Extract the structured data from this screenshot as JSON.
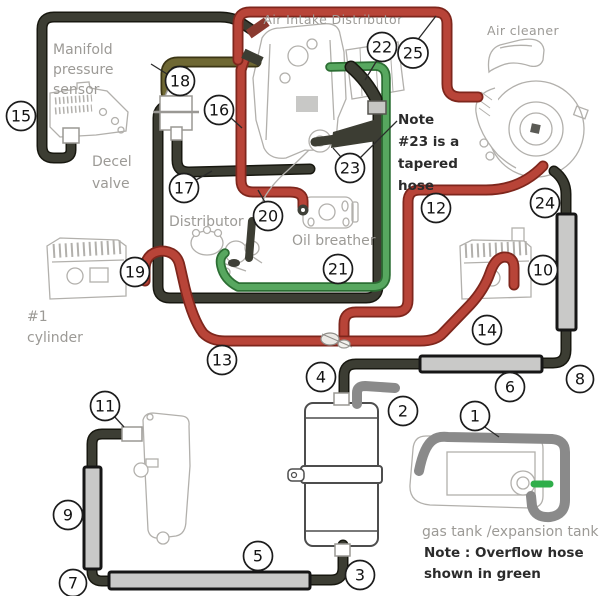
{
  "diagram": {
    "labels": {
      "air_intake_distributor": "Air Intake Distributor",
      "air_cleaner": "Air cleaner",
      "manifold_sensor": [
        "Manifold",
        "pressure",
        "sensor"
      ],
      "decel_valve": [
        "Decel",
        "valve"
      ],
      "distributor": "Distributor",
      "oil_breather": "Oil breather",
      "cylinder1": [
        "#1",
        "cylinder"
      ],
      "gas_tank": "gas tank /expansion tank",
      "note23": [
        "Note",
        "#23 is a",
        "tapered",
        "hose"
      ],
      "note_overflow": [
        "Note : Overflow hose",
        "shown in green"
      ]
    },
    "callouts": {
      "c1": "1",
      "c2": "2",
      "c3": "3",
      "c4": "4",
      "c5": "5",
      "c6": "6",
      "c7": "7",
      "c8": "8",
      "c9": "9",
      "c10": "10",
      "c11": "11",
      "c12": "12",
      "c13": "13",
      "c14": "14",
      "c15": "15",
      "c16": "16",
      "c17": "17",
      "c18": "18",
      "c19": "19",
      "c20": "20",
      "c21": "21",
      "c22": "22",
      "c23": "23",
      "c24": "24",
      "c25": "25"
    },
    "colors": {
      "hose_red": "#b84438",
      "hose_red_outline": "#7e261c",
      "hose_dark": "#3c3d33",
      "hose_dark_outline": "#17170f",
      "hose_olive": "#6f6833",
      "hose_olive_outline": "#3b3514",
      "hose_green": "#57a75f",
      "hose_green_outline": "#2c6e33",
      "hose_gray": "#8a8a8a",
      "overflow_green": "#2fae4a",
      "sleeve_fill": "#c9c9c8",
      "label_gray": "#9c9a96",
      "note_text": "#2b2b2b"
    }
  }
}
